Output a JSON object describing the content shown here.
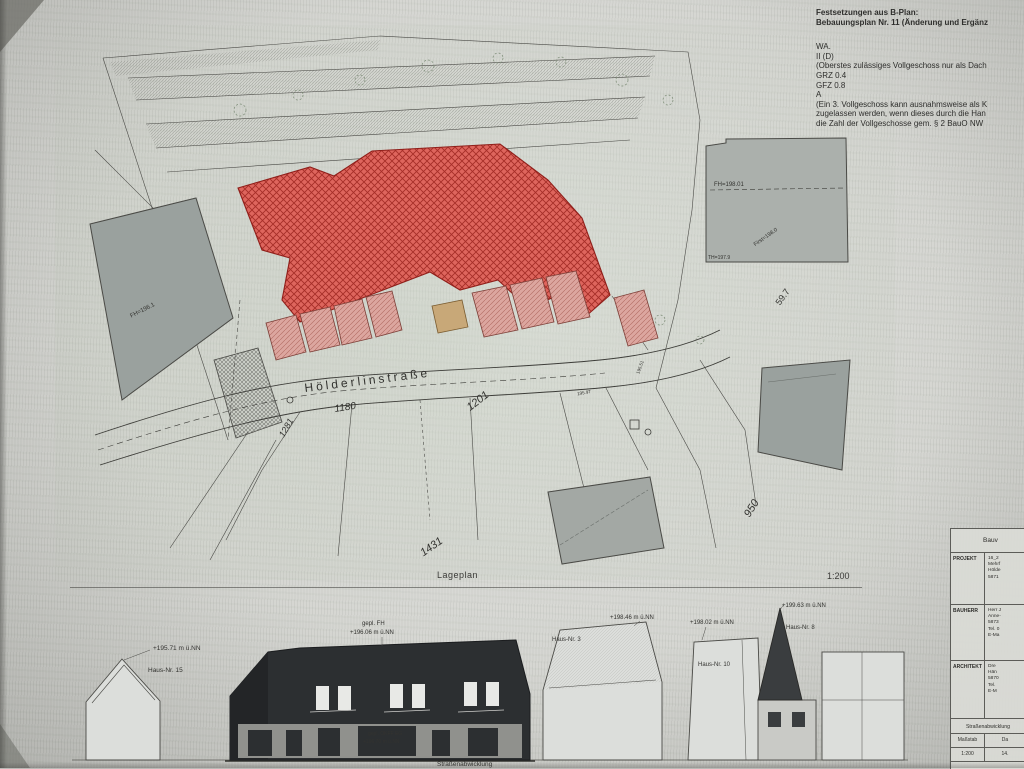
{
  "notes": {
    "title": "Festsetzungen aus B-Plan:",
    "subtitle": "Bebauungsplan Nr. 11 (Änderung und Ergänz",
    "l0": "WA.",
    "l1": "II (D)",
    "l2": "(Oberstes zulässiges Vollgeschoss nur als Dach",
    "l3": "GRZ 0.4",
    "l4": "GFZ 0.8",
    "l5": "A",
    "l6": "(Ein 3. Vollgeschoss kann ausnahmsweise als K",
    "l7": "zugelassen werden, wenn dieses durch die Han",
    "l8": "die Zahl der Vollgeschosse gem. § 2 BauO NW"
  },
  "siteplan": {
    "label": "Lageplan",
    "scale": "1:200",
    "street_name": "Hölderlinstraße",
    "parcel_1180": "1180",
    "parcel_1201": "1201",
    "parcel_1281": "1281",
    "parcel_1431": "1431",
    "parcel_950": "950",
    "parcel_597": "59.7",
    "bldg_fh_topright": "FH=198.01",
    "bldg_first_topright": "First=198.0",
    "bldg_th_topright": "TH=197.9",
    "bldg_fh_left": "FH=196.1",
    "spot_19551": "195.51",
    "spot_19597": "195.97"
  },
  "elevation": {
    "label": "Straßenabwicklung",
    "ann_19571": "+195.71 m ü.NN",
    "haus15": "Haus-Nr. 15",
    "ann_fh_label": "gepl. FH",
    "ann_fh_value": "+196.06 m ü.NN",
    "ann_19846": "+198.46 m ü.NN",
    "haus3": "Haus-Nr. 3",
    "ann_19802": "+198.02 m ü.NN",
    "haus10": "Haus-Nr. 10",
    "ann_19963": "+199.63 m ü.NN",
    "haus8": "Haus-Nr. 8",
    "okff_label": "gepl. OKFF EG",
    "okff_value": "+196.70 m ü.NN"
  },
  "titleblock": {
    "header": "Bauv",
    "projekt_label": "PROJEKT",
    "projekt_l1": "16_2",
    "projekt_l2": "Mehrf",
    "projekt_l3": "Hölde",
    "projekt_l4": "5871",
    "bauherr_label": "BAUHERR",
    "bauherr_l1": "Herr J",
    "bauherr_l2": "Anne-",
    "bauherr_l3": "5873",
    "bauherr_l4": "Tel. 0",
    "bauherr_l5": "E-Ma",
    "architekt_label": "ARCHITEKT",
    "architekt_l1": "Dre",
    "architekt_l2": "Hän",
    "architekt_l3": "5870",
    "architekt_l4": "Tel.",
    "architekt_l5": "E-M",
    "section": "Straßenabwicklung",
    "col_massstab": "Maßstab",
    "col_datum": "Da",
    "val_massstab": "1:200",
    "val_datum": "14."
  },
  "colors": {
    "red_building": "#de655d",
    "red_hatch": "#a62e28",
    "pink_building": "#dca69f",
    "gray_building": "#9ea4a0",
    "paper": "#d7dad3",
    "elevation_dark": "#2c2f31"
  }
}
